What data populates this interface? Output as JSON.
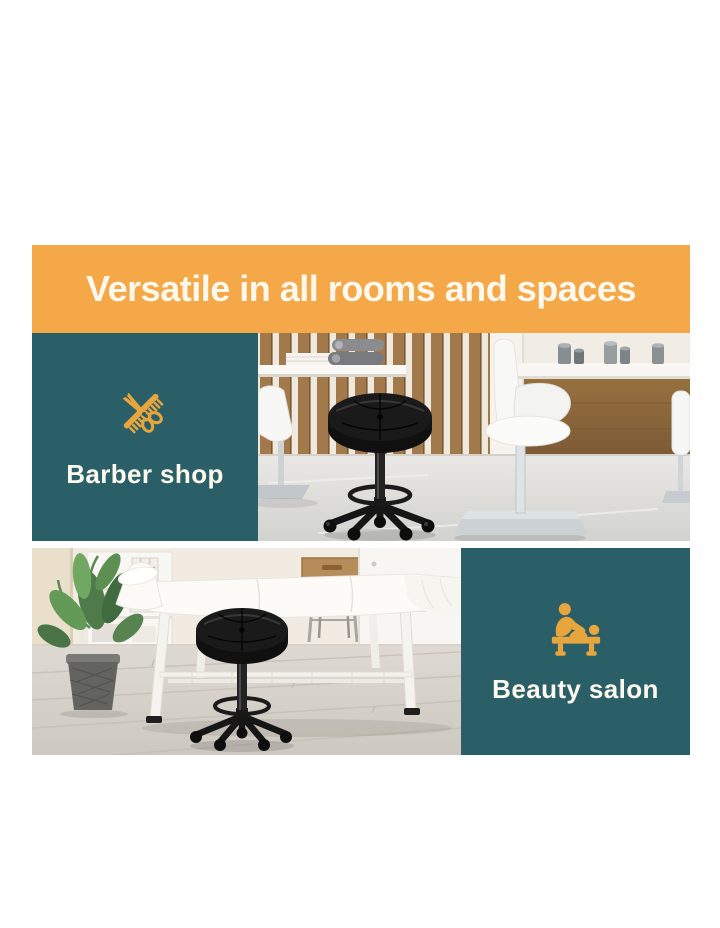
{
  "banner": {
    "title": "Versatile in all rooms and spaces"
  },
  "sections": {
    "barber": {
      "label": "Barber shop",
      "icon": "scissors-comb-icon"
    },
    "beauty": {
      "label": "Beauty salon",
      "icon": "massage-table-icon"
    }
  },
  "photos": {
    "barber": "barber-shop-interior-photo",
    "beauty": "beauty-salon-interior-photo"
  },
  "colors": {
    "page_bg": "#ffffff",
    "banner_bg": "#f5a848",
    "panel_bg": "#2b5f68",
    "icon_gold": "#e7a53e",
    "text_light": "#fcf8ed"
  }
}
